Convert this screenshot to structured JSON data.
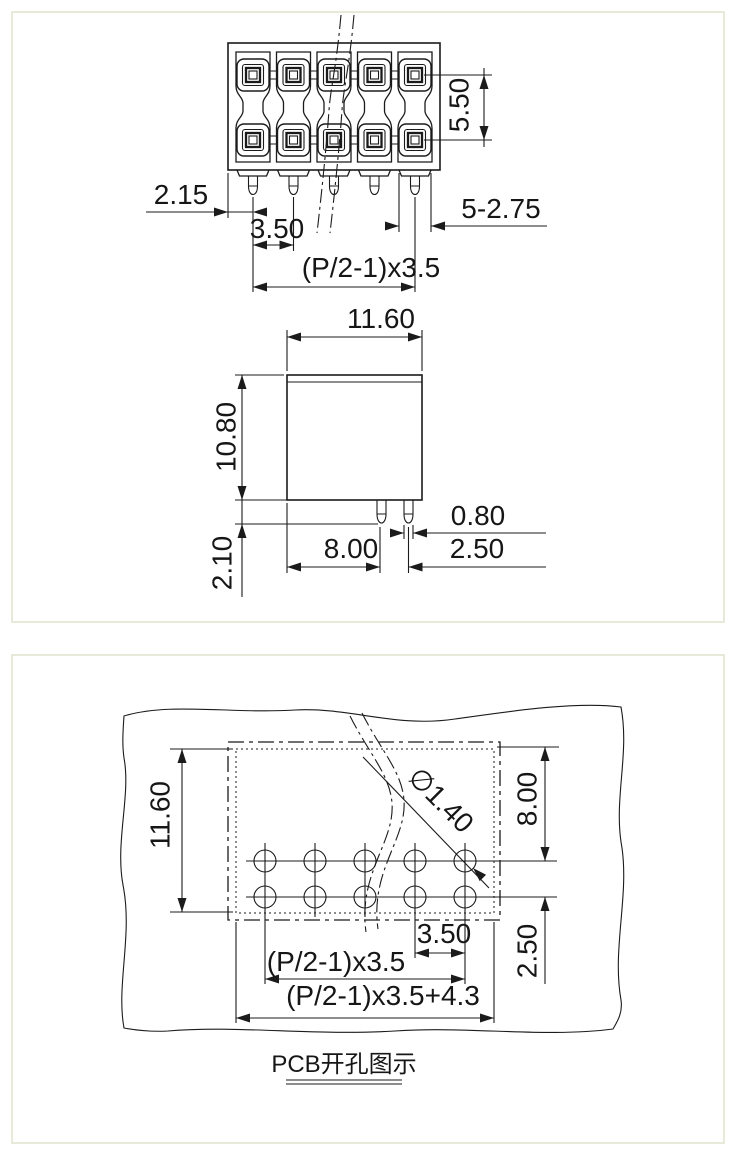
{
  "top_panel": {
    "top_view": {
      "dim_row_spacing": "5.50",
      "dim_edge_to_pin": "2.15",
      "dim_pitch_single": "3.50",
      "dim_tail_width": "5-2.75",
      "dim_pitch_formula": "(P/2-1)x3.5"
    },
    "front_view": {
      "dim_body_width": "11.60",
      "dim_body_height": "10.80",
      "dim_pin_length": "2.10",
      "dim_pin_width": "0.80",
      "dim_edge_to_pin": "8.00",
      "dim_pin_row_gap": "2.50"
    }
  },
  "bottom_panel": {
    "pcb_view": {
      "dim_outline_height": "11.60",
      "dim_top_to_row": "8.00",
      "dim_row_gap": "2.50",
      "dim_hole_diameter": "∅1.40",
      "dim_hole_pitch": "3.50",
      "dim_pitch_formula": "(P/2-1)x3.5",
      "dim_total_formula": "(P/2-1)x3.5+4.3"
    },
    "caption": "PCB开孔图示"
  }
}
